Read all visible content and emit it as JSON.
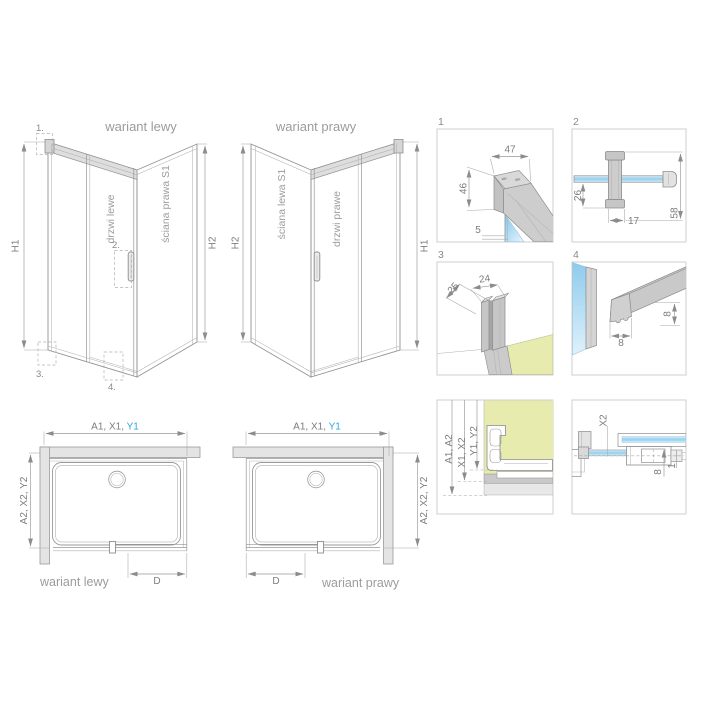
{
  "perspective_left": {
    "title": "wariant lewy",
    "door_label": "drzwi lewe",
    "wall_label": "ściana prawa S1",
    "dim_front": "H1",
    "dim_back": "H2",
    "callout_1": "1.",
    "callout_2": "2.",
    "callout_3": "3.",
    "callout_4": "4."
  },
  "perspective_right": {
    "title": "wariant prawy",
    "door_label": "drzwi prawe",
    "wall_label": "ściana lewa S1",
    "dim_front": "H1",
    "dim_back": "H2"
  },
  "plan_left": {
    "label": "wariant lewy",
    "width_dim": "A1, X1, ",
    "width_dim_highlight": "Y1",
    "depth_dim": "A2, X2, Y2",
    "door_dim": "D"
  },
  "plan_right": {
    "label": "wariant prawy",
    "width_dim": "A1, X1, ",
    "width_dim_highlight": "Y1",
    "depth_dim": "A2, X2, Y2",
    "door_dim": "D"
  },
  "details": {
    "box1": {
      "number": "1",
      "dim_top": "47",
      "dim_side": "46",
      "dim_glass": "5"
    },
    "box2": {
      "number": "2",
      "dim_left": "26",
      "dim_bottom": "17",
      "dim_right": "58"
    },
    "box3": {
      "number": "3",
      "dim_diag": "25",
      "dim_top": "24"
    },
    "box4": {
      "number": "4",
      "dim_bottom": "8",
      "dim_side": "8"
    },
    "box5": {
      "dim_a": "A1, A2",
      "dim_x": "X1, X2",
      "dim_y": "Y1, Y2"
    },
    "box6": {
      "dim_x2": "X2",
      "dim_8": "8",
      "dim_1": "1"
    }
  },
  "colors": {
    "highlight_blue": "#29a8df",
    "glass_blue": "#9fd4f0",
    "floor_yellow": "#e7ecae",
    "line_gray": "#949494",
    "text_gray": "#9c9c9c"
  }
}
